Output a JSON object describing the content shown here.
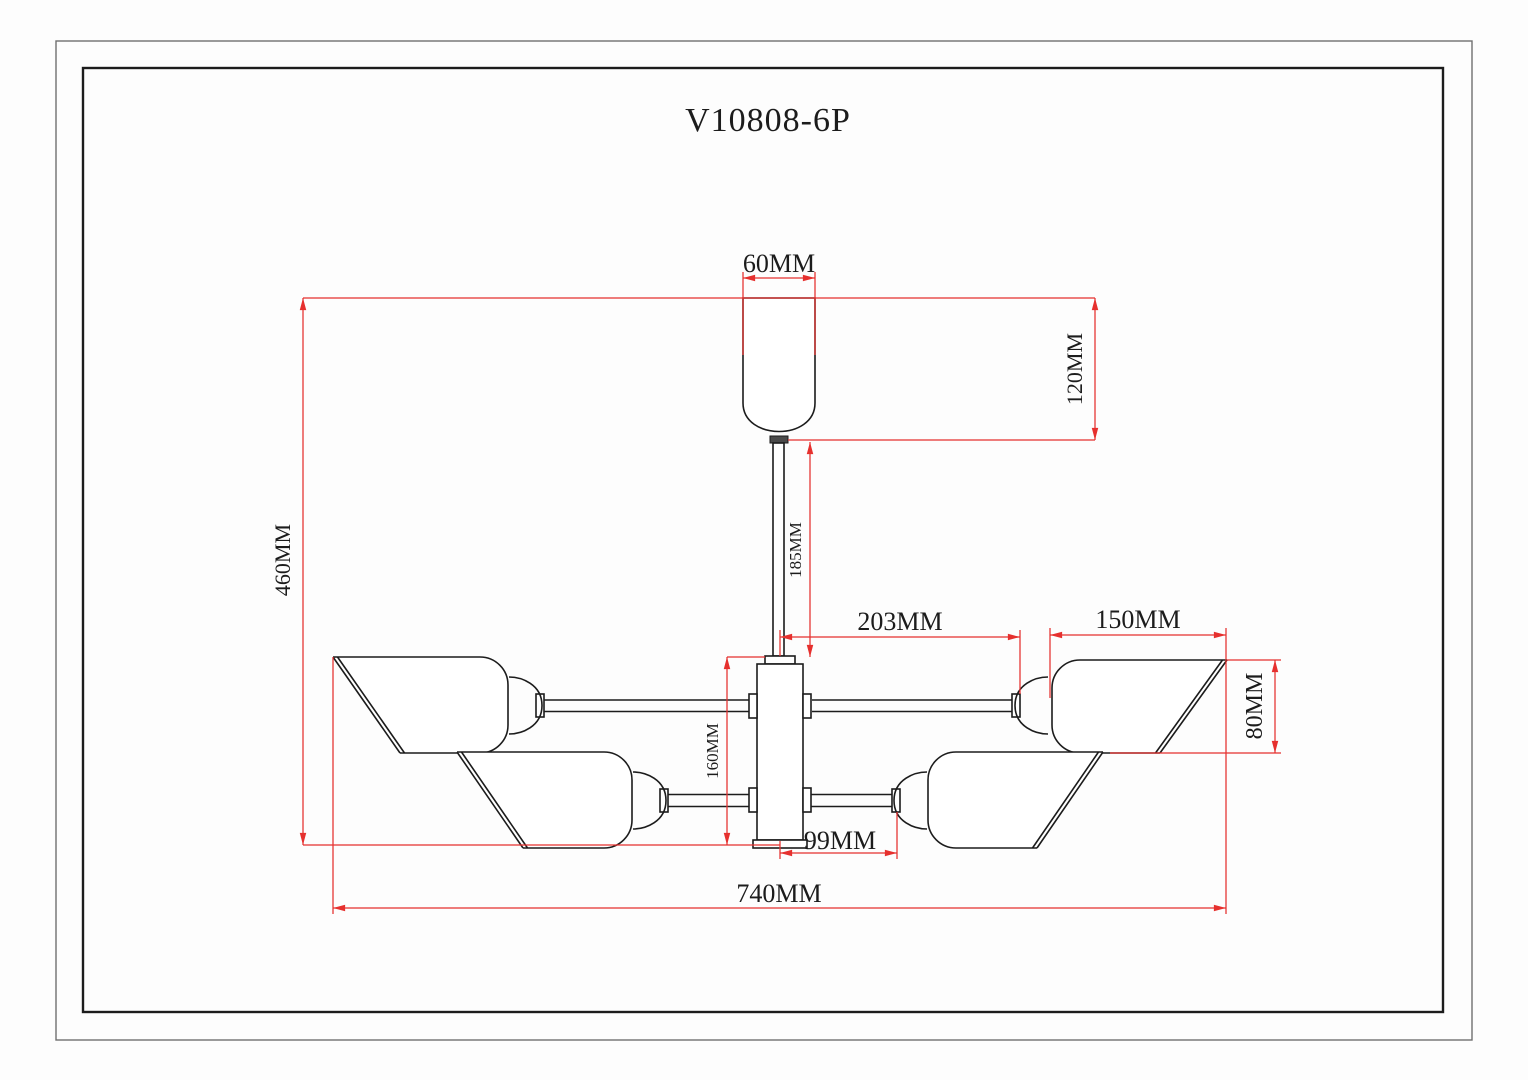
{
  "drawing": {
    "title": "V10808-6P",
    "type_note": "6-light ceiling chandelier technical dimension drawing",
    "colors": {
      "dimension_line": "#e6302e",
      "outline": "#1c1c1c",
      "background": "#fdfdfd"
    },
    "dims": {
      "w60": "60MM",
      "h120": "120MM",
      "h460": "460MM",
      "rod185": "185MM",
      "arm203": "203MM",
      "shade150": "150MM",
      "shade80": "80MM",
      "body160": "160MM",
      "arm99": "99MM",
      "total740": "740MM"
    }
  }
}
